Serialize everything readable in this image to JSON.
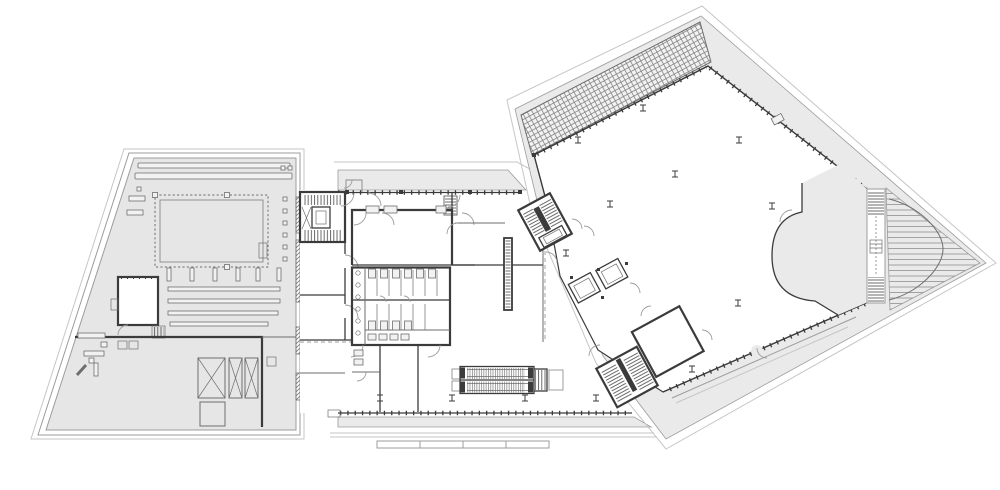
{
  "canvas": {
    "viewBox": "0 0 1000 490",
    "width": "1000",
    "height": "490"
  },
  "colors": {
    "paper": "#ffffff",
    "wing_fill": "#e6e6e6",
    "band_fill": "#eaeaea",
    "detail_fill": "#f2f2f2",
    "outline_faint": "#c6c6c6",
    "outline_light": "#9c9c9c",
    "wall_medium": "#6e6e6e",
    "wall_dark": "#3b3b3b",
    "hatch_line": "#858585"
  },
  "symbols": {
    "stair-icon": "parallel-tread-lines-with-center-rail",
    "escalator-icon": "double-track-with-dense-tread-hatch",
    "elevator-icon": "nested-rectangles",
    "door-icon": "quarter-circle-swing-arc",
    "column-marker-icon": "small-i-beam-tick",
    "skylight-grid-icon": "crosshatch-band",
    "ramp-icon": "horizontal-line-hatch",
    "toilet-stall-icon": "divided-cubicles-with-fixtures",
    "parking-stripe-icon": "long-slot-bars",
    "shaft-icon": "rectangle-with-x-cross"
  }
}
